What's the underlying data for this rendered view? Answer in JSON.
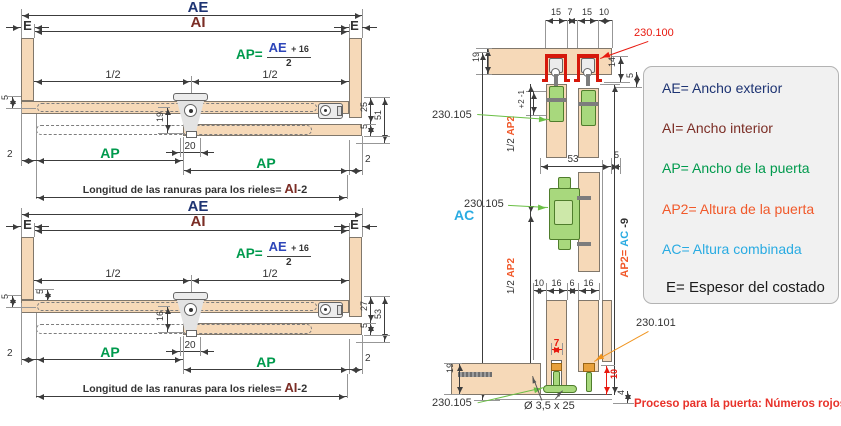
{
  "colors": {
    "navy": "#1e3473",
    "blue": "#2d46b9",
    "maroon": "#7b2d25",
    "green": "#009a4d",
    "orange": "#f1592a",
    "cyan": "#29abe2",
    "red": "#e8190f",
    "arrow_green": "#6abf45",
    "arrow_orange": "#f0941e",
    "wood": "#f6d9b8",
    "hardware_green": "#a8d87d",
    "rail_red": "#d6180b"
  },
  "plan_views": [
    {
      "ae": "AE",
      "ai": "AI",
      "e": "E",
      "half": "1/2",
      "ap": "AP",
      "formula": {
        "lhs": "AP=",
        "num": "AE",
        "plus": "+ 16",
        "den": "2"
      },
      "dims": {
        "top_offset": "5",
        "edge_left": "2",
        "center_v": "19",
        "center_h": "20",
        "right_a": "25",
        "right_b": "5",
        "right_total": "51",
        "edge_right": "2"
      },
      "slots": {
        "label": "Longitud de las ranuras para los rieles=",
        "code": "AI",
        "suffix": "-2"
      }
    },
    {
      "ae": "AE",
      "ai": "AI",
      "e": "E",
      "half": "1/2",
      "ap": "AP",
      "formula": {
        "lhs": "AP=",
        "num": "AE",
        "plus": "+ 16",
        "den": "2"
      },
      "dims": {
        "top_offset": "5",
        "inner_offset": "5",
        "edge_left": "2",
        "center_v": "16",
        "center_h": "20",
        "right_a": "27",
        "right_b": "5",
        "right_total": "53",
        "edge_right": "2"
      },
      "slots": {
        "label": "Longitud de las ranuras para los rieles=",
        "code": "AI",
        "suffix": "-2"
      }
    }
  ],
  "section": {
    "top_dims": [
      "15",
      "7",
      "15",
      "10"
    ],
    "panel_thickness": "19",
    "rail_part": "230.100",
    "rail_height": "14",
    "rail_gap": "5",
    "tolerance": "+2 -1",
    "guide_part": "230.105",
    "half_label": "1/2",
    "ap2_label": "AP2",
    "door_span": "53",
    "door_gap": "5",
    "ac_label": "AC",
    "ap2_formula": {
      "lhs": "AP2=",
      "ac": "AC",
      "rest": " -9"
    },
    "lower_dims": [
      "10",
      "16",
      "6",
      "16"
    ],
    "slot_width": "7",
    "bottom_thickness": "19",
    "bottom_part": "230.101",
    "door_clearance": "10",
    "base_gap": "4",
    "screw_spec": "Ø 3,5 x 25"
  },
  "legend": {
    "items": [
      {
        "code": "AE=",
        "label": "Ancho exterior",
        "color": "#1e3473"
      },
      {
        "code": "AI=",
        "label": "Ancho interior",
        "color": "#7b2d25"
      },
      {
        "code": "AP=",
        "label": "Ancho de la puerta",
        "color": "#009a4d"
      },
      {
        "code": "AP2=",
        "label": "Altura de la puerta",
        "color": "#f1592a"
      },
      {
        "code": "AC=",
        "label": "Altura combinada",
        "color": "#29abe2"
      },
      {
        "code": "E=",
        "label": "Espesor del costado",
        "color": "#1c1c1c"
      }
    ]
  },
  "note": {
    "text": "Proceso para la puerta: Números rojos",
    "color": "#e8322a"
  }
}
